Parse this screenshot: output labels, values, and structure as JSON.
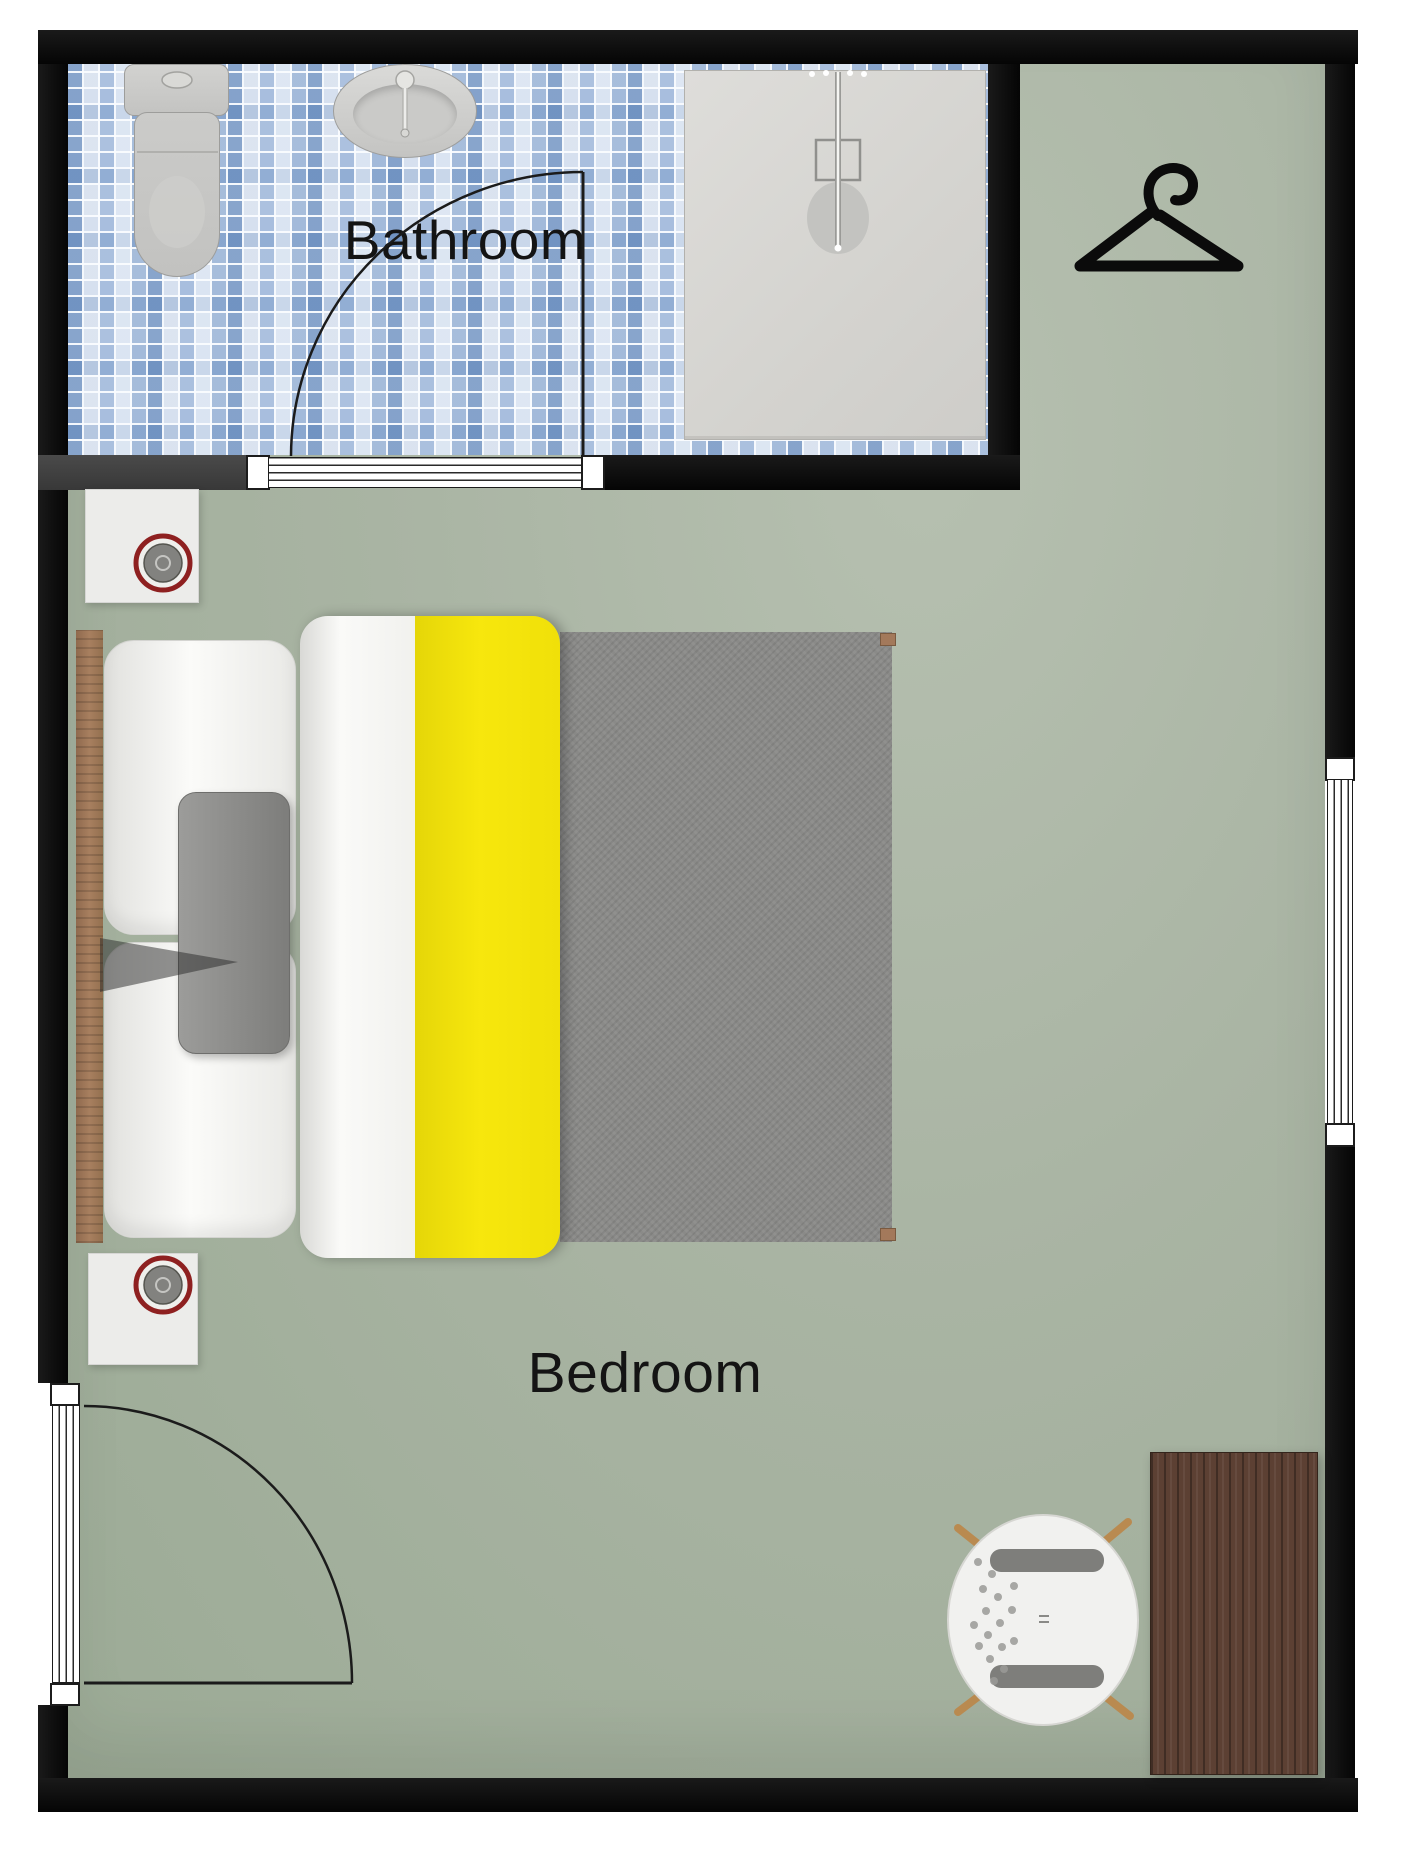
{
  "floorplan": {
    "rooms": [
      {
        "name": "bathroom",
        "label": "Bathroom"
      },
      {
        "name": "bedroom",
        "label": "Bedroom"
      }
    ],
    "furniture": [
      "toilet",
      "sink",
      "shower",
      "clothes-hanger",
      "double-bed",
      "nightstand",
      "speaker-device",
      "desk",
      "office-chair",
      "entrance-door",
      "bathroom-door",
      "window"
    ],
    "colors": {
      "wall_black": "#0e0e0e",
      "interior_wall_gray": "#424242",
      "floor_sage_green": "#a9b4a3",
      "bathroom_tile_blue": "#7fa3cd",
      "shower_pan_gray": "#d8d7d3",
      "duvet_white": "#f6f6f3",
      "duvet_yellow": "#f3e30b",
      "blanket_gray": "#8a8a88",
      "bed_wood": "#a3795b",
      "desk_walnut": "#5c4033",
      "accent_ring_red": "#8e2020",
      "fixture_gray": "#c9c9c7"
    }
  }
}
